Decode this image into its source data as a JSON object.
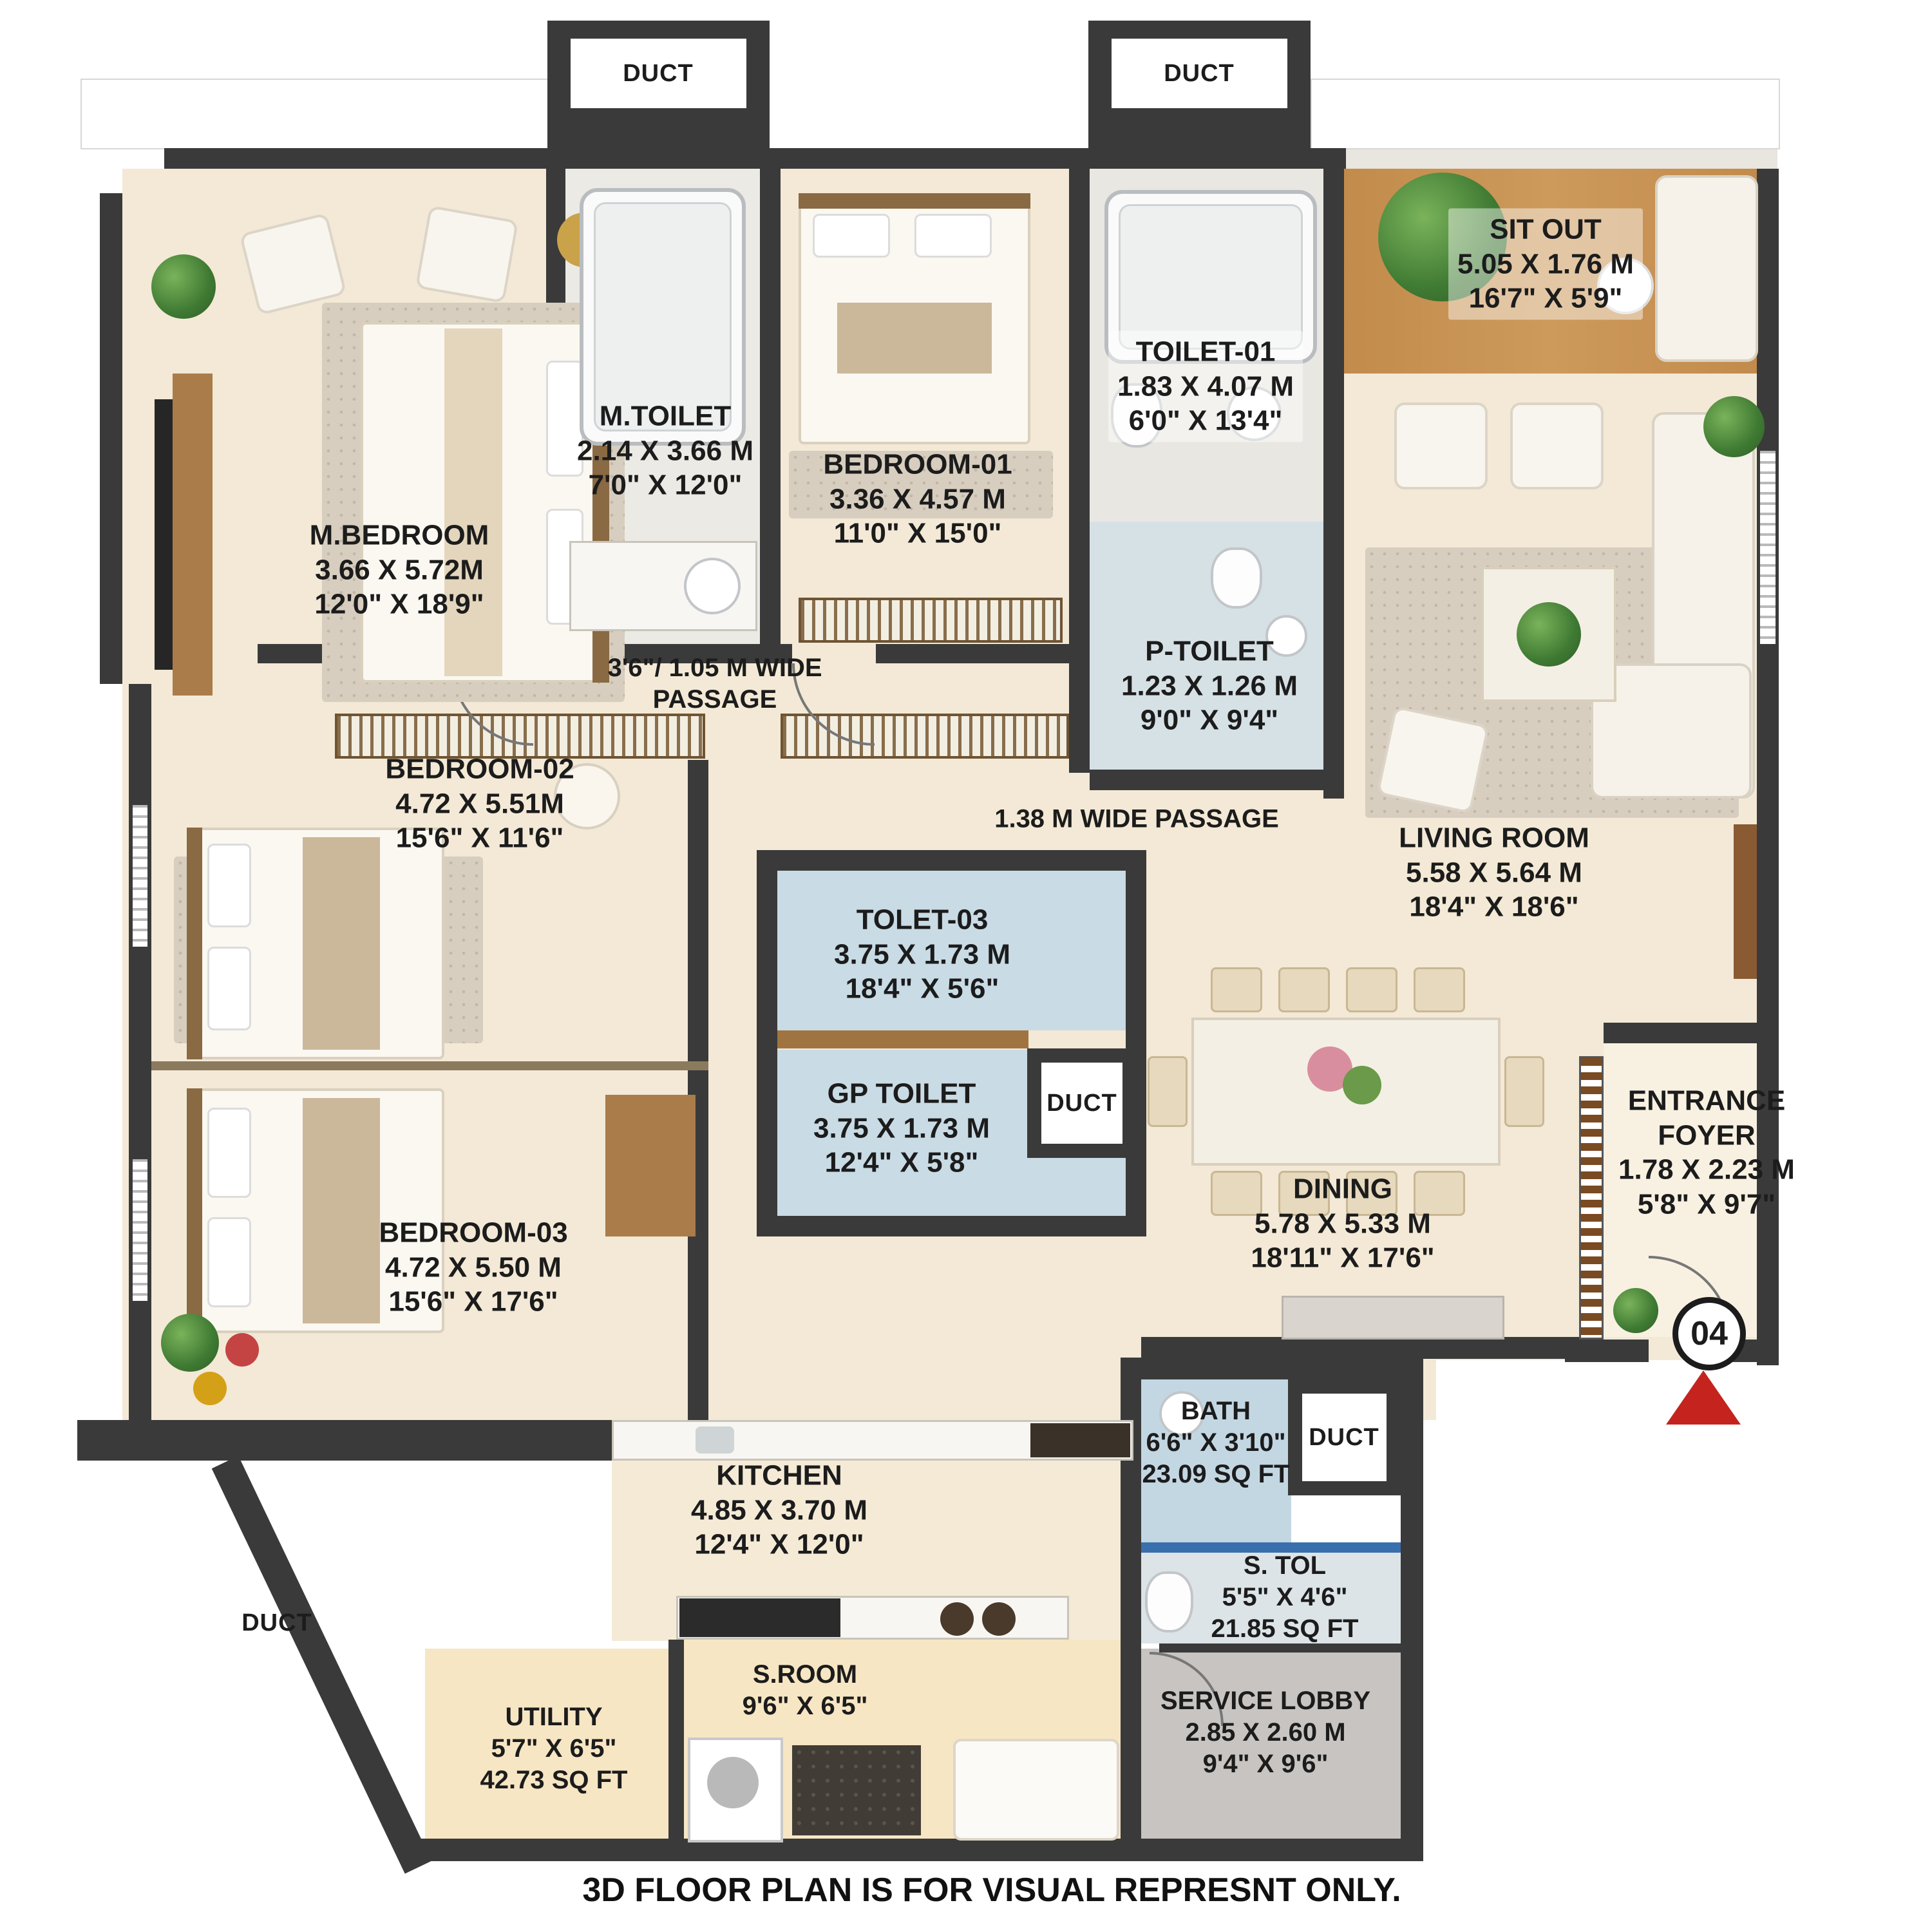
{
  "rooms": {
    "m_bedroom": {
      "name": "M.BEDROOM",
      "dim_m": "3.66 X 5.72M",
      "dim_ft": "12'0\" X 18'9\""
    },
    "m_toilet": {
      "name": "M.TOILET",
      "dim_m": "2.14 X 3.66 M",
      "dim_ft": "7'0\" X 12'0\""
    },
    "bedroom_01": {
      "name": "BEDROOM-01",
      "dim_m": "3.36 X 4.57 M",
      "dim_ft": "11'0\" X 15'0\""
    },
    "toilet_01": {
      "name": "TOILET-01",
      "dim_m": "1.83 X 4.07 M",
      "dim_ft": "6'0\" X 13'4\""
    },
    "sit_out": {
      "name": "SIT OUT",
      "dim_m": "5.05 X 1.76 M",
      "dim_ft": "16'7\" X 5'9\""
    },
    "p_toilet": {
      "name": "P-TOILET",
      "dim_m": "1.23 X 1.26 M",
      "dim_ft": "9'0\" X 9'4\""
    },
    "living_room": {
      "name": "LIVING ROOM",
      "dim_m": "5.58 X 5.64 M",
      "dim_ft": "18'4\" X 18'6\""
    },
    "bedroom_02": {
      "name": "BEDROOM-02",
      "dim_m": "4.72 X 5.51M",
      "dim_ft": "15'6\" X 11'6\""
    },
    "tolet_03": {
      "name": "TOLET-03",
      "dim_m": "3.75 X 1.73 M",
      "dim_ft": "18'4\" X 5'6\""
    },
    "gp_toilet": {
      "name": "GP TOILET",
      "dim_m": "3.75 X 1.73 M",
      "dim_ft": "12'4\" X 5'8\""
    },
    "bedroom_03": {
      "name": "BEDROOM-03",
      "dim_m": "4.72 X 5.50 M",
      "dim_ft": "15'6\" X 17'6\""
    },
    "dining": {
      "name": "DINING",
      "dim_m": "5.78 X 5.33 M",
      "dim_ft": "18'11\" X 17'6\""
    },
    "entrance_foyer": {
      "name": "ENTRANCE FOYER",
      "dim_m": "1.78 X 2.23 M",
      "dim_ft": "5'8\" X 9'7\""
    },
    "kitchen": {
      "name": "KITCHEN",
      "dim_m": "4.85 X 3.70 M",
      "dim_ft": "12'4\" X 12'0\""
    },
    "bath": {
      "name": "BATH",
      "dim_ft": "6'6\" X 3'10\"",
      "area": "23.09 SQ FT"
    },
    "s_tol": {
      "name": "S. TOL",
      "dim_ft": "5'5\" X 4'6\"",
      "area": "21.85 SQ FT"
    },
    "service_lobby": {
      "name": "SERVICE LOBBY",
      "dim_m": "2.85 X 2.60 M",
      "dim_ft": "9'4\" X 9'6\""
    },
    "utility": {
      "name": "UTILITY",
      "dim_ft": "5'7\" X 6'5\"",
      "area": "42.73 SQ FT"
    },
    "s_room": {
      "name": "S.ROOM",
      "dim_ft": "9'6\" X 6'5\""
    }
  },
  "passages": {
    "wide_105_line1": "3'6\"/ 1.05 M WIDE",
    "wide_105_line2": "PASSAGE",
    "wide_138": "1.38 M WIDE PASSAGE"
  },
  "labels": {
    "duct": "DUCT",
    "unit_number": "04",
    "disclaimer": "3D FLOOR PLAN IS FOR VISUAL REPRESNT ONLY."
  },
  "colors": {
    "wall": "#3a3a3a",
    "floor_cream": "#f3e9d6",
    "toilet_blue": "#c9dbe5",
    "deck_wood": "#c28b4b",
    "service_gray": "#c8c4c1",
    "entrance_marker_red": "#c4241d"
  }
}
